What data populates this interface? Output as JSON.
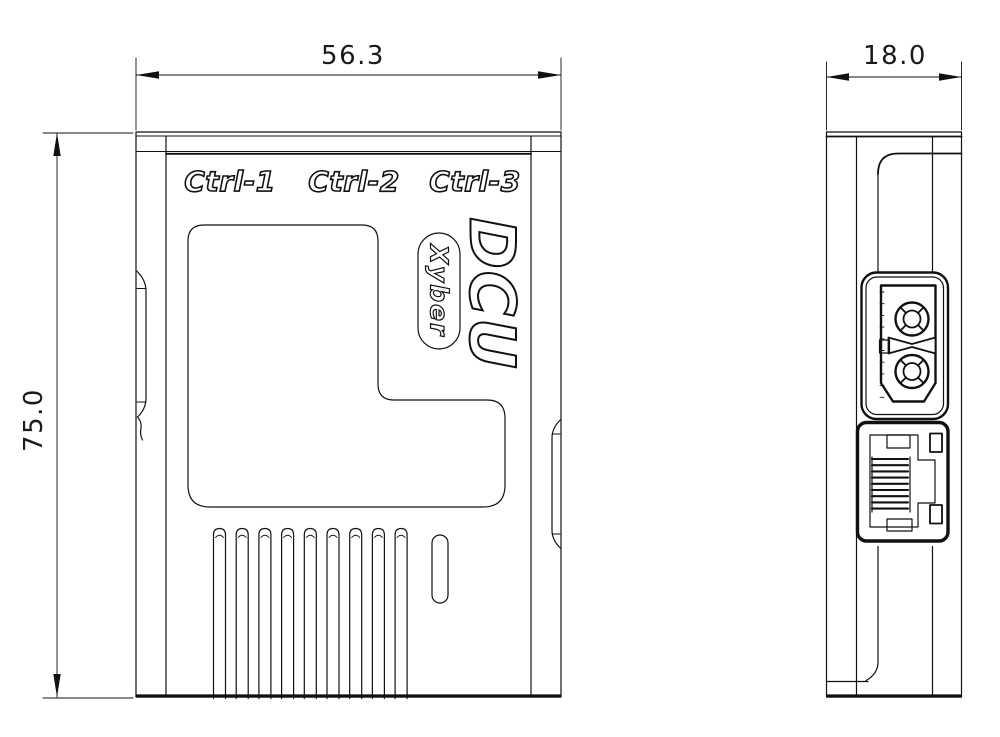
{
  "front_view": {
    "width_dim": "56.3",
    "height_dim": "75.0",
    "port_labels": [
      "Ctrl-1",
      "Ctrl-2",
      "Ctrl-3"
    ],
    "product_logo": "DCU",
    "brand_badge": "Xyber",
    "vent_slot_count": 9
  },
  "side_view": {
    "depth_dim": "18.0",
    "ethernet_pin_count": 9
  },
  "colors": {
    "line": "#111111",
    "background": "#ffffff"
  }
}
